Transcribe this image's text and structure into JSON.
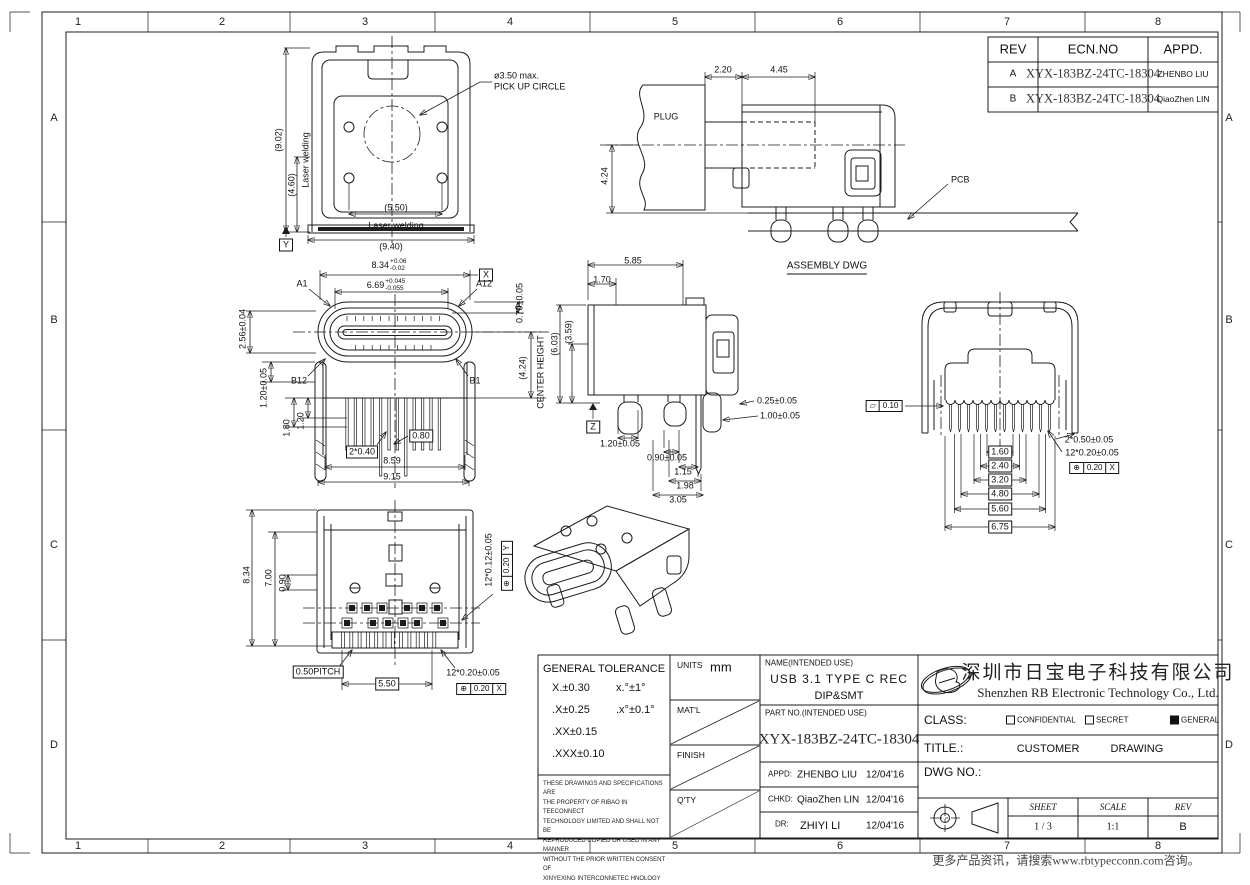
{
  "sheet": {
    "zones": {
      "cols": [
        "1",
        "2",
        "3",
        "4",
        "5",
        "6",
        "7",
        "8"
      ],
      "rows": [
        "A",
        "B",
        "C",
        "D"
      ]
    },
    "footer": "更多产品资讯，请搜索www.rbtypecconn.com咨询。"
  },
  "rev_table": {
    "headers": {
      "rev": "REV",
      "ecn": "ECN.NO",
      "appd": "APPD."
    },
    "rows": [
      {
        "rev": "A",
        "ecn": "XYX-183BZ-24TC-18304",
        "appd": "ZHENBO LIU"
      },
      {
        "rev": "B",
        "ecn": "XYX-183BZ-24TC-18304",
        "appd": "QiaoZhen LIN"
      }
    ]
  },
  "views": {
    "front": {
      "h_total": "(9.02)",
      "h_weld": "(4.60)",
      "laser_v": "Laser welding",
      "w_weld": "(5.50)",
      "laser_h": "Laser welding",
      "w_total": "(9.40)",
      "datum": "Y",
      "pickup_dia": "ø3.50 max.",
      "pickup_note": "PICK UP CIRCLE"
    },
    "assembly": {
      "plug": "PLUG",
      "pcb": "PCB",
      "caption": "ASSEMBLY DWG",
      "d1": "2.20",
      "d2": "4.45",
      "d3": "4.24"
    },
    "mating": {
      "w_shell": "8.34",
      "w_shell_up": "+0.06",
      "w_shell_dn": "-0.02",
      "datum_x": "X",
      "w_tongue": "6.69",
      "w_tongue_up": "+0.045",
      "w_tongue_dn": "-0.055",
      "pin_a1": "A1",
      "pin_a12": "A12",
      "pin_b1": "B1",
      "pin_b12": "B12",
      "d_tongue_off": "0.70±0.05",
      "d_shell_h": "2.56±0.04",
      "d_leg": "1.20±0.05",
      "d_leg2": "1.80",
      "d_leg3": "1.20",
      "d_pin_w": "2*0.40",
      "d_pin_gap": "0.80",
      "w_legs": "8.59",
      "w_max": "9.15",
      "center_h": "(4.24)",
      "center_note": "CENTER HEIGHT"
    },
    "side": {
      "d_depth": "5.85",
      "d_front": "1.70",
      "h_shell": "(3.59)",
      "h_total": "(6.03)",
      "datum": "Z",
      "d_pin_t": "0.25±0.05",
      "d_leg_w": "1.00±0.05",
      "d1": "1.20±0.05",
      "d2": "0.90±0.05",
      "d3": "1.15",
      "d4": "1.98",
      "d5": "3.05"
    },
    "rear": {
      "flatness": "0.10",
      "spans": [
        "1.60",
        "2.40",
        "3.20",
        "4.80",
        "5.60",
        "6.75"
      ],
      "d_leg": "2*0.50±0.05",
      "d_pins": "12*0.20±0.05",
      "pos_tol": "0.20",
      "pos_datum": "X"
    },
    "bottom": {
      "h_total": "8.34",
      "h_body": "7.00",
      "d_pad": "0.90",
      "d_pads": "12*0.12±0.05",
      "posy_tol": "0.20",
      "posy_datum": "Y",
      "pitch": "0.50PITCH",
      "w_pins": "5.50",
      "d_pins": "12*0.20±0.05",
      "posx_tol": "0.20",
      "posx_datum": "X"
    }
  },
  "title_block": {
    "tolerance": {
      "title": "GENERAL TOLERANCE",
      "r1a": "X.±0.30",
      "r1b": "x.°±1°",
      "r2a": ".X±0.25",
      "r2b": ".x°±0.1°",
      "r3a": ".XX±0.15",
      "r4a": ".XXX±0.10",
      "legal": [
        "THESE DRAWINGS AND SPECIFICATIONS ARE",
        "THE PROPERTY OF RIBAO IN TEECONNECT",
        "TECHNOLOGY LIMITED AND SHALL NOT BE",
        "REPRODUCED COPIED OR USED IN ANY MANNER",
        "WITHOUT THE PRIOR  WRITTEN CONSENT OF",
        "XINYEXING INTERCONNETEC HNOLOGY LIMITEDCT"
      ]
    },
    "meta": {
      "units_label": "UNITS",
      "units": "mm",
      "matl": "MAT'L",
      "finish": "FINISH",
      "qty": "Q'TY"
    },
    "name": {
      "label": "NAME(INTENDED USE)",
      "line1": "USB 3.1 TYPE C REC",
      "line2": "DIP&SMT"
    },
    "part": {
      "label": "PART NO.(INTENDED USE)",
      "number": "XYX-183BZ-24TC-18304"
    },
    "approvals": {
      "appd_label": "APPD:",
      "appd_name": "ZHENBO LIU",
      "appd_date": "12/04'16",
      "chkd_label": "CHKD:",
      "chkd_name": "QiaoZhen LIN",
      "chkd_date": "12/04'16",
      "dr_label": "DR:",
      "dr_name": "ZHIYI LI",
      "dr_date": "12/04'16"
    },
    "company": {
      "cn": "深圳市日宝电子科技有限公司",
      "en": "Shenzhen RB Electronic Technology Co., Ltd."
    },
    "class": {
      "label": "CLASS:",
      "opt1": "CONFIDENTIAL",
      "opt2": "SECRET",
      "opt3": "GENERAL"
    },
    "title": {
      "label": "TITLE.:",
      "value": "CUSTOMER DRAWING"
    },
    "dwg": {
      "label": "DWG NO.:"
    },
    "issue": {
      "sheet_label": "SHEET",
      "sheet": "1 / 3",
      "scale_label": "SCALE",
      "scale": "1:1",
      "rev_label": "REV",
      "rev": "B"
    }
  },
  "colors": {
    "line": "#1c1c1c",
    "logo_orange": "#F5A623",
    "logo_blue": "#2BA8E0",
    "logo_yellow": "#FFD34D"
  }
}
